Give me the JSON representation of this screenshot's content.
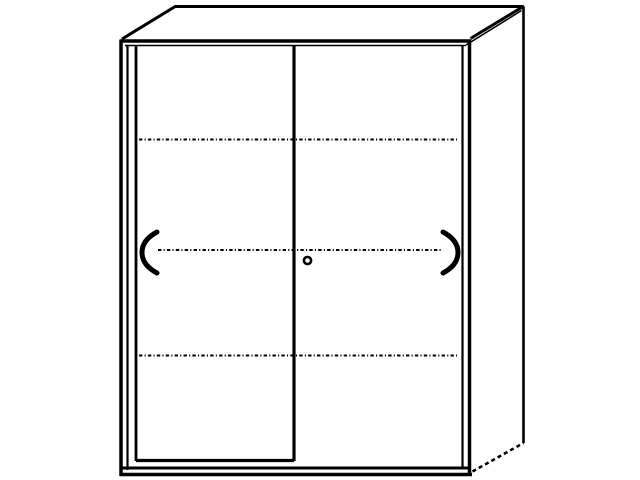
{
  "canvas": {
    "width": 640,
    "height": 480,
    "background_color": "#ffffff",
    "line_color": "#000000"
  },
  "figure": {
    "kind": "sliding-door-cabinet-line-drawing",
    "doors": 2,
    "handles": 2,
    "shelf_lines": 3,
    "lock": 1
  },
  "drawing": {
    "elements": [
      {
        "type": "line",
        "name": "front-top-outer-edge",
        "x1": 120,
        "y1": 41,
        "x2": 471,
        "y2": 41,
        "w": 3.5
      },
      {
        "type": "line",
        "name": "front-top-inner-edge",
        "x1": 125,
        "y1": 45.5,
        "x2": 466,
        "y2": 45.5,
        "w": 1.6
      },
      {
        "type": "line",
        "name": "front-left-outer-edge",
        "x1": 121,
        "y1": 39.5,
        "x2": 121,
        "y2": 476,
        "w": 3.5
      },
      {
        "type": "line",
        "name": "front-left-inner-edge",
        "x1": 127.5,
        "y1": 45,
        "x2": 127.5,
        "y2": 470,
        "w": 2.2
      },
      {
        "type": "line",
        "name": "left-door-left-edge",
        "x1": 136,
        "y1": 46,
        "x2": 136,
        "y2": 461,
        "w": 2.8
      },
      {
        "type": "line",
        "name": "door-center-divider",
        "x1": 294,
        "y1": 45.5,
        "x2": 294,
        "y2": 461,
        "w": 3.2
      },
      {
        "type": "line",
        "name": "right-door-right-edge",
        "x1": 462.5,
        "y1": 46,
        "x2": 462.5,
        "y2": 467,
        "w": 2.2
      },
      {
        "type": "line",
        "name": "front-right-outer-edge",
        "x1": 469.5,
        "y1": 39.5,
        "x2": 469.5,
        "y2": 476,
        "w": 3.5
      },
      {
        "type": "line",
        "name": "left-door-bottom-edge",
        "x1": 136,
        "y1": 460.5,
        "x2": 294,
        "y2": 460.5,
        "w": 3.2
      },
      {
        "type": "line",
        "name": "front-bottom-inner-edge",
        "x1": 121,
        "y1": 468,
        "x2": 470,
        "y2": 468,
        "w": 3
      },
      {
        "type": "line",
        "name": "front-bottom-outer-edge",
        "x1": 119.5,
        "y1": 474.5,
        "x2": 472,
        "y2": 474.5,
        "w": 3.5
      },
      {
        "type": "line",
        "name": "top-back-edge",
        "x1": 175,
        "y1": 6.5,
        "x2": 523.5,
        "y2": 6.5,
        "w": 3
      },
      {
        "type": "line",
        "name": "top-left-slant-edge",
        "x1": 122,
        "y1": 39,
        "x2": 176,
        "y2": 6,
        "w": 3
      },
      {
        "type": "line",
        "name": "top-right-slant-outer-edge",
        "x1": 470.5,
        "y1": 38.5,
        "x2": 524,
        "y2": 6,
        "w": 3
      },
      {
        "type": "line",
        "name": "top-right-slant-inner-edge",
        "x1": 466,
        "y1": 45,
        "x2": 521.5,
        "y2": 10.5,
        "w": 1.6
      },
      {
        "type": "line",
        "name": "side-back-right-edge",
        "x1": 523.5,
        "y1": 6.5,
        "x2": 523.5,
        "y2": 443,
        "w": 2.6
      },
      {
        "type": "line",
        "name": "side-bottom-slant-edge",
        "x1": 472.5,
        "y1": 471.5,
        "x2": 523.5,
        "y2": 443,
        "w": 2.6,
        "dash": "4 3.2"
      },
      {
        "type": "line",
        "name": "shelf-dash-line-top",
        "x1": 139,
        "y1": 139.5,
        "x2": 457,
        "y2": 139.5,
        "w": 1.9,
        "dash": "3.4 2.2 1.1 2.2"
      },
      {
        "type": "line",
        "name": "shelf-dash-line-middle",
        "x1": 158,
        "y1": 250,
        "x2": 441,
        "y2": 250,
        "w": 1.9,
        "dash": "3.4 2.2 1.1 2.2"
      },
      {
        "type": "line",
        "name": "shelf-dash-line-bottom",
        "x1": 139,
        "y1": 355.5,
        "x2": 457,
        "y2": 355.5,
        "w": 1.9,
        "dash": "3.4 2.2 1.1 2.2"
      },
      {
        "type": "path",
        "name": "left-door-handle",
        "d": "M157,232 Q142,240 142,252.5 Q142,265 157,273",
        "w": 5
      },
      {
        "type": "path",
        "name": "right-door-handle",
        "d": "M443,232 Q458,240 458,252.5 Q458,265 443,273",
        "w": 5
      },
      {
        "type": "circle",
        "name": "lock-cylinder",
        "cx": 307.5,
        "cy": 260.5,
        "r": 3.6,
        "w": 2.6
      }
    ]
  }
}
